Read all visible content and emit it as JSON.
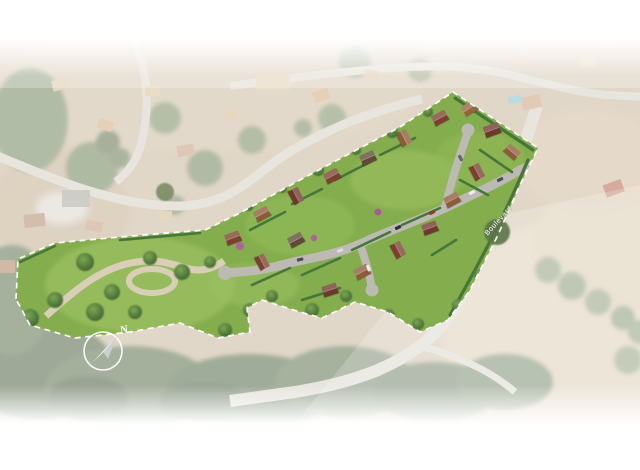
{
  "scene": {
    "type": "aerial-development-site-plan-render",
    "road_label": "Boulevard",
    "compass_label": "N",
    "site": {
      "boundary_style": "white-dashed",
      "houses_count": 18,
      "park_position": "west-end",
      "field_position": "south-east"
    },
    "colors": {
      "background_base": "#c9b69b",
      "veil": "#ffffff",
      "lawn": "#84ad4d",
      "park_lawn": "#95bb5c",
      "tree_dark": "#3a5f2f",
      "tree_light": "#7ca653",
      "hedge": "#47763a",
      "internal_road": "#bcbab2",
      "park_path": "#d9cfb6",
      "roof_red_brown": "#7c4030",
      "roof_brown": "#8d5a3a",
      "roof_dark": "#5f4a38",
      "field": "#d8c5a5",
      "bg_road": "#d6d0c4",
      "pool": "#7fc0c9",
      "boundary": "#ffffff"
    }
  }
}
